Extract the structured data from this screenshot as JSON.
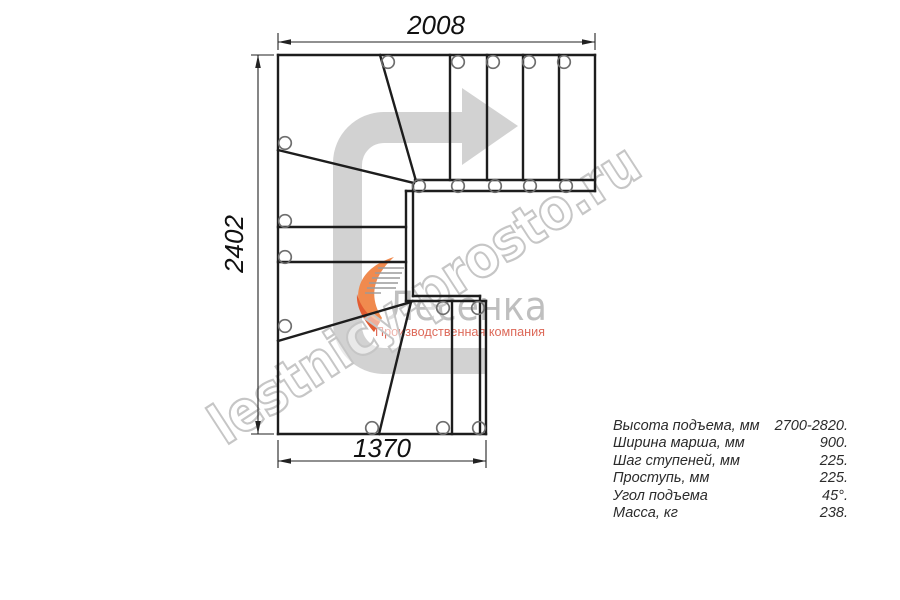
{
  "dimensions": {
    "top": "2008",
    "left": "2402",
    "bottom": "1370"
  },
  "specs": {
    "rows": [
      {
        "label": "Высота подъема, мм",
        "value": "2700-2820."
      },
      {
        "label": "Ширина марша, мм",
        "value": "900."
      },
      {
        "label": "Шаг ступеней, мм",
        "value": "225."
      },
      {
        "label": "Проступь, мм",
        "value": "225."
      },
      {
        "label": "Угол подъема",
        "value": "45°."
      },
      {
        "label": "Масса, кг",
        "value": "238."
      }
    ]
  },
  "watermark": {
    "text": "lestnicy-prosto.ru"
  },
  "logo": {
    "name": "Лесенка",
    "tagline": "Производственная компания"
  },
  "colors": {
    "plan_line": "#1d1d1d",
    "dim_line": "#222222",
    "circle_stroke": "#6e6e6e",
    "arrow_fill": "#d2d2d2",
    "watermark_stroke": "#c6c6c6",
    "logo_name": "#bfbfbf",
    "logo_tagline": "#dd6a5a",
    "swoosh_orange": "#f08a4e",
    "swoosh_deep": "#e25b31",
    "spec_text": "#2b2b2b"
  },
  "plan": {
    "line_width": 2.4,
    "circle_radius": 6.3,
    "lines": [
      [
        278,
        55,
        595,
        55
      ],
      [
        595,
        55,
        595,
        191
      ],
      [
        278,
        55,
        278,
        434
      ],
      [
        278,
        434,
        486,
        434
      ],
      [
        415,
        180,
        595,
        180
      ],
      [
        406,
        191,
        595,
        191
      ],
      [
        450,
        55,
        450,
        180
      ],
      [
        487,
        55,
        487,
        180
      ],
      [
        523,
        55,
        523,
        180
      ],
      [
        559,
        55,
        559,
        180
      ],
      [
        380,
        55,
        416,
        181
      ],
      [
        278,
        150,
        414,
        183
      ],
      [
        278,
        227,
        406,
        227
      ],
      [
        278,
        262,
        406,
        262
      ],
      [
        413,
        183,
        413,
        296
      ],
      [
        406,
        191,
        406,
        301
      ],
      [
        413,
        296,
        480,
        296
      ],
      [
        406,
        301,
        486,
        301
      ],
      [
        278,
        341,
        411,
        302
      ],
      [
        411,
        302,
        379,
        434
      ],
      [
        452,
        301,
        452,
        434
      ],
      [
        480,
        296,
        480,
        434
      ],
      [
        486,
        301,
        486,
        434
      ]
    ],
    "circles": [
      [
        388,
        62
      ],
      [
        458,
        62
      ],
      [
        493,
        62
      ],
      [
        529,
        62
      ],
      [
        564,
        62
      ],
      [
        419,
        186
      ],
      [
        458,
        186
      ],
      [
        495,
        186
      ],
      [
        530,
        186
      ],
      [
        566,
        186
      ],
      [
        285,
        143
      ],
      [
        285,
        221
      ],
      [
        285,
        257
      ],
      [
        285,
        326
      ],
      [
        443,
        308
      ],
      [
        478,
        308
      ],
      [
        372,
        428
      ],
      [
        443,
        428
      ],
      [
        479,
        428
      ]
    ]
  }
}
